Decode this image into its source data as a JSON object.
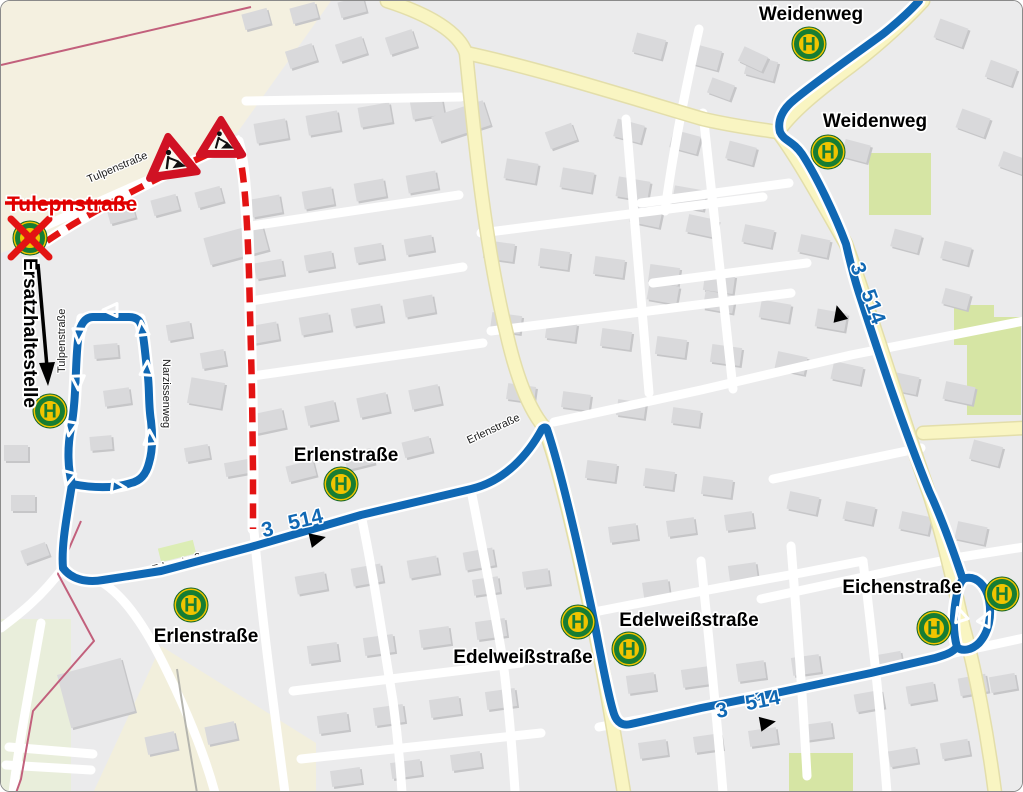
{
  "map": {
    "route": {
      "line_a": "3",
      "line_b": "514"
    },
    "closed_street_label": "Tulepnstraße",
    "replacement_stop_label": "Ersatzhaltestelle",
    "stop_letter": "H",
    "stops": [
      {
        "id": "weidenweg-north",
        "label": "Weidenweg"
      },
      {
        "id": "weidenweg-south",
        "label": "Weidenweg"
      },
      {
        "id": "erlenstrasse-east",
        "label": "Erlenstraße"
      },
      {
        "id": "erlenstrasse-west",
        "label": "Erlenstraße"
      },
      {
        "id": "edelweissstrasse-west",
        "label": "Edelweißstraße"
      },
      {
        "id": "edelweissstrasse-east",
        "label": "Edelweißstraße"
      },
      {
        "id": "eichenstrasse",
        "label": "Eichenstraße"
      }
    ],
    "street_labels": [
      {
        "id": "tulpenstrasse-top",
        "label": "Tulpenstraße"
      },
      {
        "id": "tulpenstrasse-vertical",
        "label": "Tulpenstraße"
      },
      {
        "id": "narzissenweg",
        "label": "Narzissenweg"
      },
      {
        "id": "erlenstrasse-west",
        "label": "Erlenstraße"
      },
      {
        "id": "erlenstrasse-mid",
        "label": "Erlenstraße"
      }
    ],
    "colors": {
      "route_blue": "#1068b4",
      "closed_red": "#e31313",
      "stop_green": "#177d33",
      "stop_yellow": "#f0c400",
      "road_yellow": "#f9f5c2"
    }
  }
}
